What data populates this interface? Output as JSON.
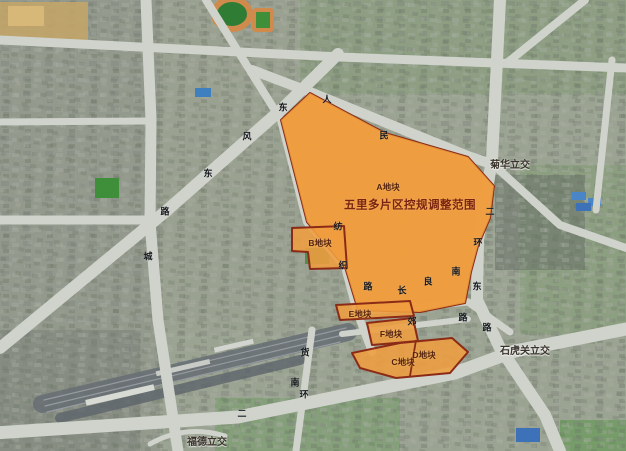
{
  "map": {
    "title": "五里多片区控规调整范围",
    "parcels": {
      "a": {
        "label": "A地块"
      },
      "b": {
        "label": "B地块"
      },
      "c": {
        "label": "C地块"
      },
      "d": {
        "label": "D地块"
      },
      "e": {
        "label": "E地块"
      },
      "f": {
        "label": "F地块"
      }
    },
    "interchanges": {
      "juhua": "菊华立交",
      "shihuguan": "石虎关立交",
      "fude": "福德立交"
    },
    "road_chars": {
      "dongfeng_east": [
        "东",
        "风",
        "东",
        "路"
      ],
      "renmin_east": [
        "人",
        "民"
      ],
      "fangzhi": [
        "纺",
        "织",
        "路"
      ],
      "changliang": [
        "长",
        "良",
        "南"
      ],
      "erhuan_east": [
        "二",
        "环",
        "东",
        "路"
      ],
      "nan_erhuan": [
        "南",
        "环",
        "二"
      ],
      "dongjiao": [
        "郊",
        "路"
      ],
      "huancheng_east": [
        "城"
      ],
      "railway_area": [
        "货"
      ]
    },
    "colors": {
      "parcel_fill": "#EF9D3F",
      "parcel_border": "#8B2B17",
      "title_text": "#7C2412",
      "road": "#CFD3CB",
      "railway": "#666D73"
    }
  }
}
